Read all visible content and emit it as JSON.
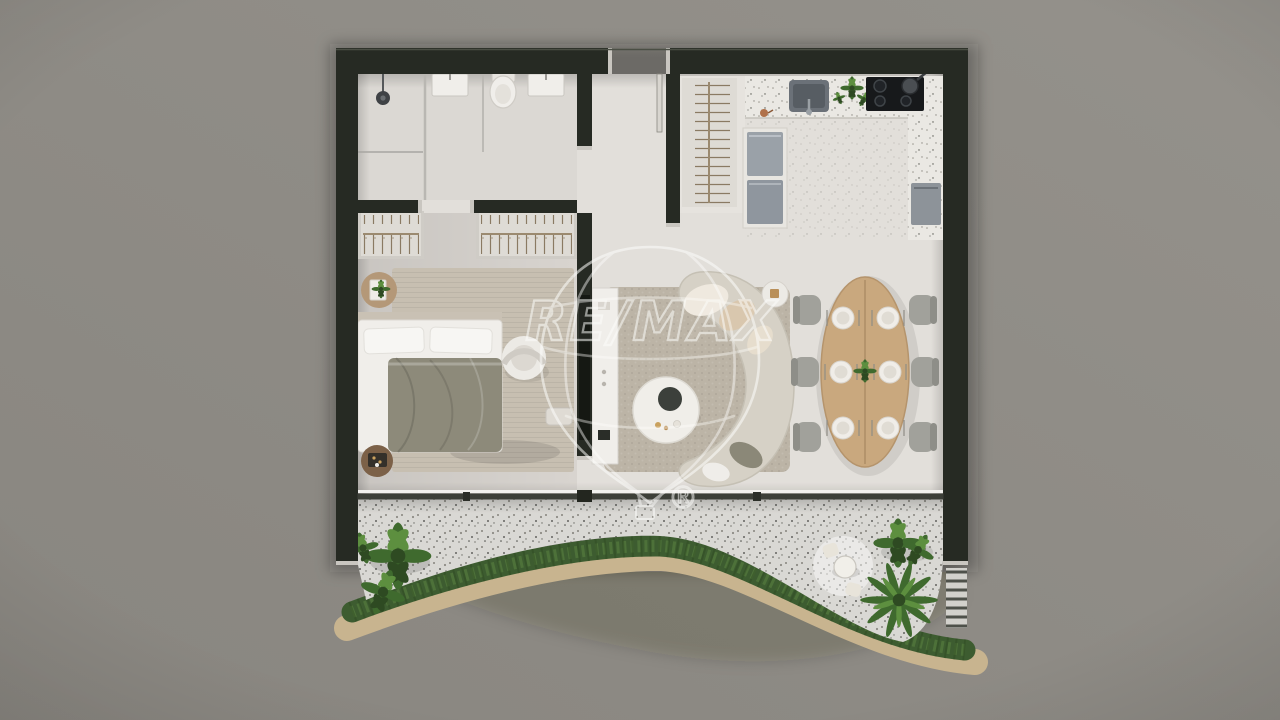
{
  "watermark": {
    "brand": "RE/MAX",
    "registered": "®"
  },
  "inventory": {
    "dining_chairs": 6,
    "dining_place_settings": 6,
    "cooktop_burners": 4,
    "bedroom_wardrobes": 2,
    "hall_coat_closet": 1,
    "bathroom_sinks": 2,
    "terrace_bistro_seats": 2
  },
  "colors": {
    "bg": "#8e8b85",
    "wall": "#262a23",
    "wallCap": "#c9c6c0",
    "floorMain": "#e2dfda",
    "floorBed": "#d8d4cf",
    "floorBath": "#dbd8d3",
    "terraceFloor": "#d9d8d4",
    "counter": "#eae8e3",
    "hedge": "#3d5c30",
    "hedgeLight": "#567c3f",
    "sand": "#c8b48f",
    "wood": "#c9a87e",
    "rugBed": "#c7bfb1",
    "rugLiving": "#bcb4a6",
    "sofa": "#d6d1c6",
    "duvet": "#8d8a7a",
    "white": "#f0eeea",
    "applianceLight": "#9aa1a8",
    "applianceDark": "#8f969e",
    "cooktop": "#17191b",
    "steel": "#6b7178",
    "steelDark": "#575d63",
    "plantDark": "#2e4a22",
    "plantMid": "#3f6a2e",
    "plantLight": "#5d8f3f",
    "pouf": "#7c6148",
    "sideTableWood": "#b49878",
    "chairGray": "#a1a19b",
    "chairGrayDark": "#8e8e88",
    "glassTrack": "#3c3f38",
    "copper": "#b0714a",
    "watermark": "#fdfdfb"
  }
}
